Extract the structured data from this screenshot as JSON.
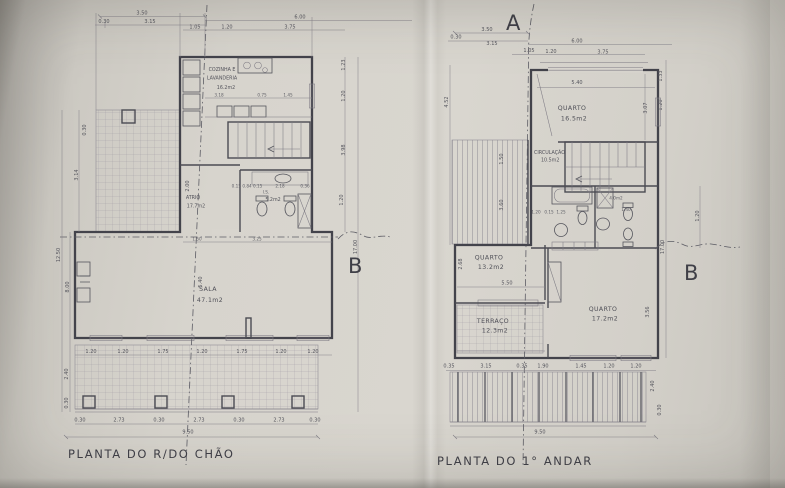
{
  "markers": {
    "a": "A",
    "b_left": "B",
    "b_right": "B"
  },
  "ground": {
    "title": "PLANTA DO R/DO CHÃO",
    "rooms": {
      "kitchen1": "COZINHA E",
      "kitchen2": "LAVANDERIA",
      "kitchen_area": "16.2m2",
      "atrio": "ATRIO",
      "atrio_area": "17.7m2",
      "bath": "I.S.",
      "bath_area": "5.2m2",
      "sala": "SALA",
      "sala_area": "47.1m2"
    },
    "dims": {
      "top": [
        "3.50",
        "0.30",
        "3.15",
        "6.00",
        "1.05",
        "1.20",
        "3.75"
      ],
      "kitchen": [
        "3.18",
        "0.75",
        "1.45"
      ],
      "bath": [
        "0.15 0.84 0.15",
        "2.18",
        "0.36"
      ],
      "interior": [
        "2.00",
        "5.40",
        "1.50",
        "3.25"
      ],
      "left": [
        "0.30",
        "3.14",
        "12.50",
        "8.00",
        "2.40",
        "0.30"
      ],
      "right": [
        "1.23",
        "1.20",
        "3.98",
        "1.20",
        "17.00"
      ],
      "windows": [
        "1.20",
        "1.20",
        "1.75",
        "1.20",
        "1.75",
        "1.20",
        "1.20"
      ],
      "columns": [
        "0.30",
        "2.73",
        "0.30",
        "2.73",
        "0.30",
        "2.73",
        "0.30"
      ],
      "total": "9.50"
    }
  },
  "first": {
    "title": "PLANTA DO 1° ANDAR",
    "rooms": {
      "quarto1": "QUARTO",
      "quarto1_area": "16.5m2",
      "circ": "CIRCULAÇÃO",
      "circ_area": "10.5m2",
      "bath_area": "4.0m2",
      "quarto2": "QUARTO",
      "quarto2_area": "13.2m2",
      "terraco": "TERRAÇO",
      "terraco_area": "12.3m2",
      "quarto3": "QUARTO",
      "quarto3_area": "17.2m2"
    },
    "dims": {
      "top": [
        "3.50",
        "0.30",
        "3.15",
        "6.00",
        "1.05",
        "1.20",
        "3.75"
      ],
      "interior": [
        "5.40",
        "3.07",
        "1.50",
        "3.60",
        "5.50",
        "2.68",
        "3.56",
        "1.20",
        "0.15",
        "1.25",
        "1.40"
      ],
      "left": [
        "4.52"
      ],
      "right": [
        "1.33",
        "1.20",
        "1.20",
        "17.00",
        "2.40",
        "0.30"
      ],
      "bottom": [
        "0.35",
        "3.15",
        "0.35",
        "1.90",
        "1.45",
        "1.20",
        "1.20"
      ],
      "total": "9.50"
    }
  }
}
